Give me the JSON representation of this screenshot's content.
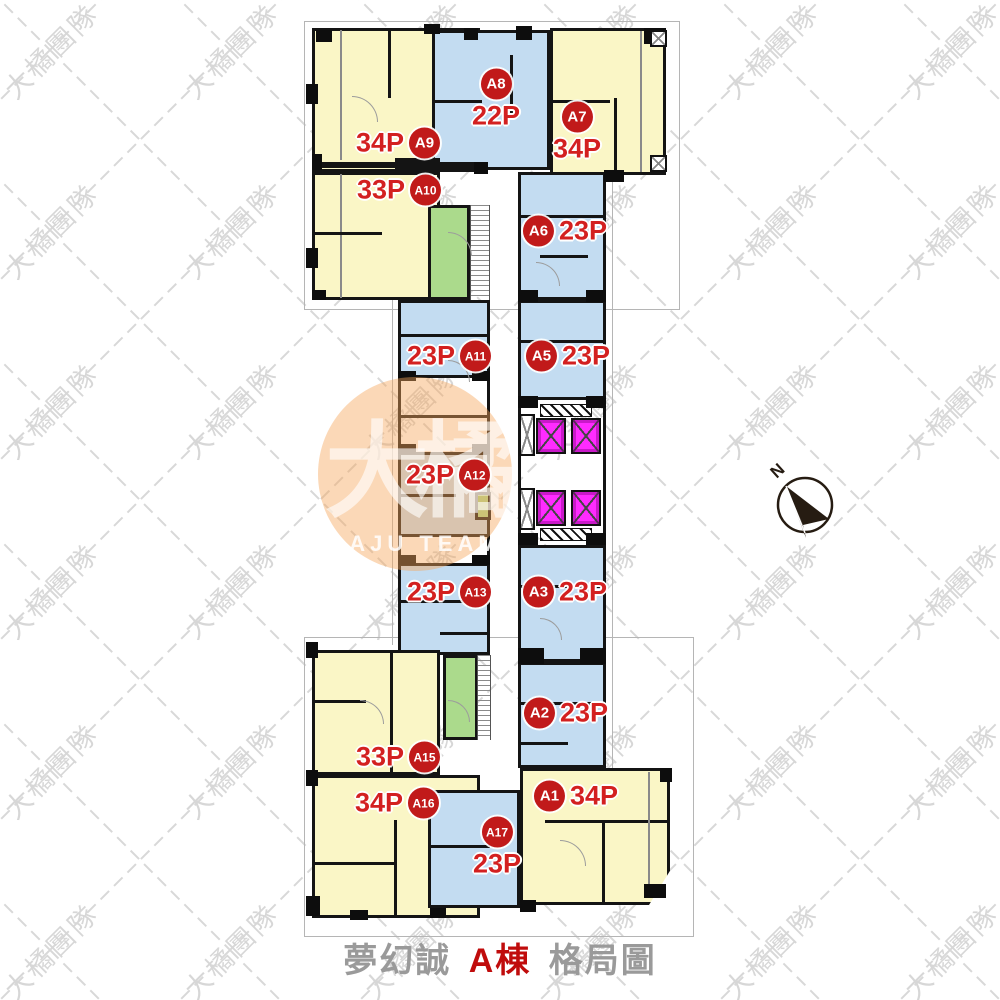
{
  "title": {
    "project": "夢幻誠",
    "building": "A棟",
    "suffix": "格局圖"
  },
  "compass": {
    "label": "N"
  },
  "watermark": {
    "tile_text": "大橘團隊",
    "logo_text": "大橘",
    "logo_subtext": "DAJU TEAM"
  },
  "units": {
    "A1": {
      "id": "A1",
      "size": "34P"
    },
    "A2": {
      "id": "A2",
      "size": "23P"
    },
    "A3": {
      "id": "A3",
      "size": "23P"
    },
    "A5": {
      "id": "A5",
      "size": "23P"
    },
    "A6": {
      "id": "A6",
      "size": "23P"
    },
    "A7": {
      "id": "A7",
      "size": "34P"
    },
    "A8": {
      "id": "A8",
      "size": "22P"
    },
    "A9": {
      "id": "A9",
      "size": "34P"
    },
    "A10": {
      "id": "A10",
      "size": "33P"
    },
    "A11": {
      "id": "A11",
      "size": "23P"
    },
    "A12": {
      "id": "A12",
      "size": "23P"
    },
    "A13": {
      "id": "A13",
      "size": "23P"
    },
    "A15": {
      "id": "A15",
      "size": "33P"
    },
    "A16": {
      "id": "A16",
      "size": "34P"
    },
    "A17": {
      "id": "A17",
      "size": "23P"
    }
  },
  "colors": {
    "unit_yellow": "#FAF6C6",
    "unit_blue": "#C3DCF1",
    "stair_green": "#ABDA8C",
    "elevator_magenta": "#FF2BFF",
    "badge_red": "#C11A1A",
    "size_text_red": "#D32020",
    "title_gray": "#9A9A9A",
    "title_red": "#C00C0C",
    "watermark_gray": "#D7D7D7",
    "logo_orange": "#F6A65C"
  }
}
